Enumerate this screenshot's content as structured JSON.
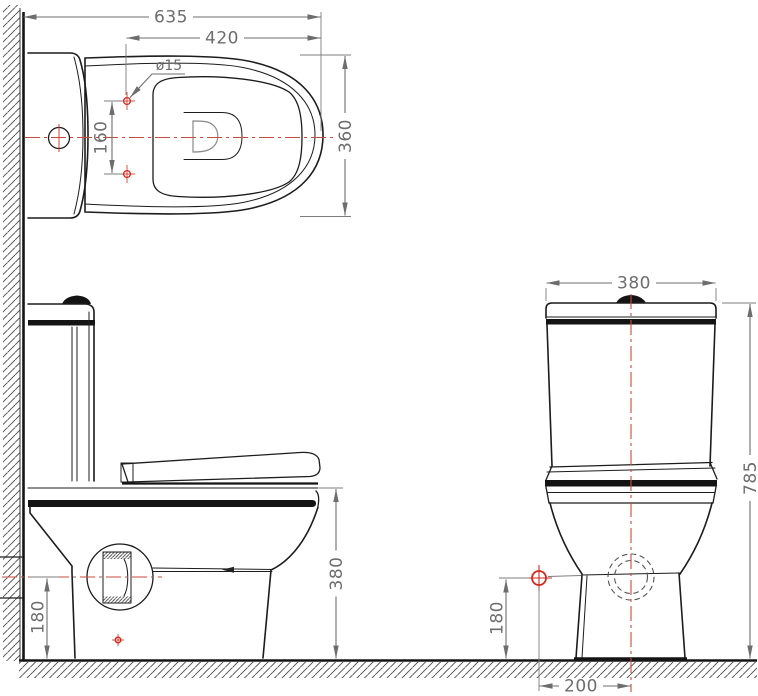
{
  "drawing": {
    "kind": "sanitary-ware dimensional drawing (close-coupled toilet, three views)",
    "dimensions": {
      "top_view": {
        "overall_depth": "635",
        "seat_length": "420",
        "hinge_hole_diameter": "ø15",
        "hinge_hole_spacing": "160",
        "bowl_width": "360"
      },
      "side_view": {
        "rim_height": "380",
        "outlet_center_height": "180"
      },
      "front_view": {
        "tank_width": "380",
        "overall_height": "785",
        "supply_point_height": "180",
        "supply_offset_from_center": "200"
      }
    },
    "colors": {
      "object_line": "#1c1c1c",
      "dimension_line": "#6d6d6d",
      "centerline_red": "#c84b3c",
      "marker_red": "#d3281e",
      "hatch": "#4a4a4a",
      "background": "#ffffff"
    }
  }
}
